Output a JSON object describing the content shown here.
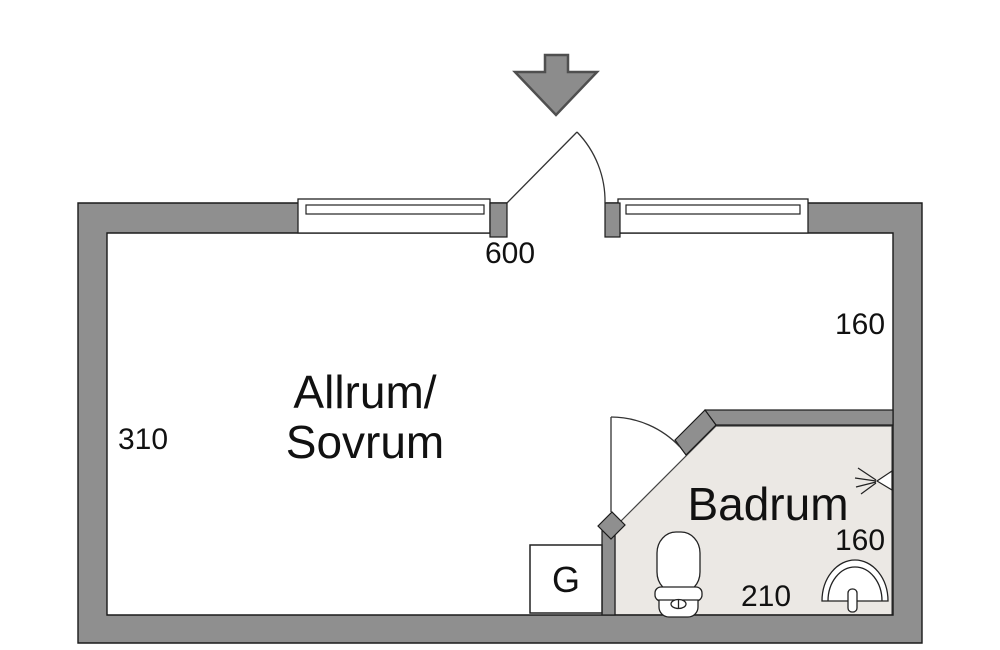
{
  "floorplan": {
    "title": "studio-apartment-floor-plan",
    "rooms": {
      "main_room": {
        "name_line1": "Allrum/",
        "name_line2": "Sovrum",
        "width_label": "600",
        "left_height_label": "310",
        "right_height_label": "160"
      },
      "bathroom": {
        "name": "Badrum",
        "width_label": "210",
        "height_label": "160",
        "fixtures": [
          "toilet",
          "sink",
          "shower"
        ]
      },
      "closet": {
        "label": "G"
      }
    },
    "icons": [
      "entrance-arrow-icon",
      "window-icon",
      "door-swing-icon",
      "toilet-icon",
      "sink-icon",
      "shower-icon"
    ],
    "colors": {
      "wall": "#8f8f8f",
      "wall_outline": "#1a1a1a",
      "bathroom_floor": "#ebe8e4",
      "arrow_fill": "#8c8c8c",
      "arrow_border": "#4f4f4f",
      "line": "#333333",
      "background": "#ffffff"
    }
  }
}
